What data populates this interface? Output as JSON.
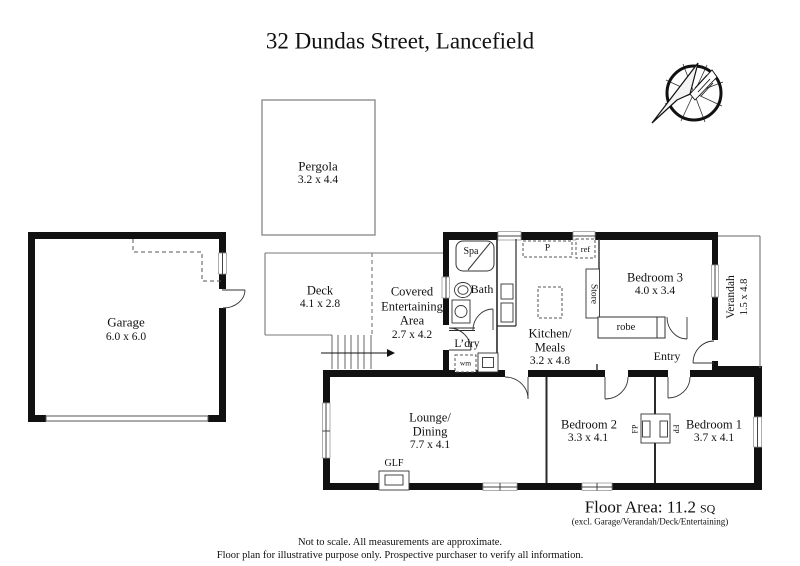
{
  "title": "32 Dundas Street, Lancefield",
  "rooms": {
    "pergola": {
      "name": "Pergola",
      "dims": "3.2 x 4.4"
    },
    "garage": {
      "name": "Garage",
      "dims": "6.0 x 6.0"
    },
    "deck": {
      "name": "Deck",
      "dims": "4.1 x 2.8"
    },
    "covered_entertaining": {
      "name_line1": "Covered",
      "name_line2": "Entertaining",
      "name_line3": "Area",
      "dims": "2.7 x 4.2"
    },
    "kitchen_meals": {
      "name_line1": "Kitchen/",
      "name_line2": "Meals",
      "dims": "3.2 x 4.8"
    },
    "bedroom3": {
      "name": "Bedroom 3",
      "dims": "4.0 x 3.4"
    },
    "verandah": {
      "name": "Verandah",
      "dims": "1.5 x 4.8"
    },
    "lounge_dining": {
      "name_line1": "Lounge/",
      "name_line2": "Dining",
      "dims": "7.7 x 4.1"
    },
    "bedroom2": {
      "name": "Bedroom 2",
      "dims": "3.3 x 4.1"
    },
    "bedroom1": {
      "name": "Bedroom 1",
      "dims": "3.7 x 4.1"
    },
    "bath": {
      "name": "Bath"
    },
    "spa": {
      "name": "Spa"
    },
    "laundry": {
      "name": "L’dry"
    },
    "entry": {
      "name": "Entry"
    }
  },
  "fixtures": {
    "washing_machine": "wm",
    "pantry": "P",
    "fridge": "ref",
    "store": "Store",
    "robe": "robe",
    "gas_log_fire": "GLF",
    "fireplace": "FP"
  },
  "footer": {
    "floor_area": "Floor Area: 11.2",
    "floor_area_unit": "SQ",
    "floor_area_note": "(excl. Garage/Verandah/Deck/Entertaining)",
    "disclaimer1": "Not to scale. All measurements are approximate.",
    "disclaimer2": "Floor plan for illustrative purpose only. Prospective purchaser to verify all information."
  },
  "icons": {
    "compass": "compass-rose-arrow"
  },
  "colors": {
    "wall": "#111111",
    "thin_line": "#555555",
    "background": "#ffffff"
  }
}
